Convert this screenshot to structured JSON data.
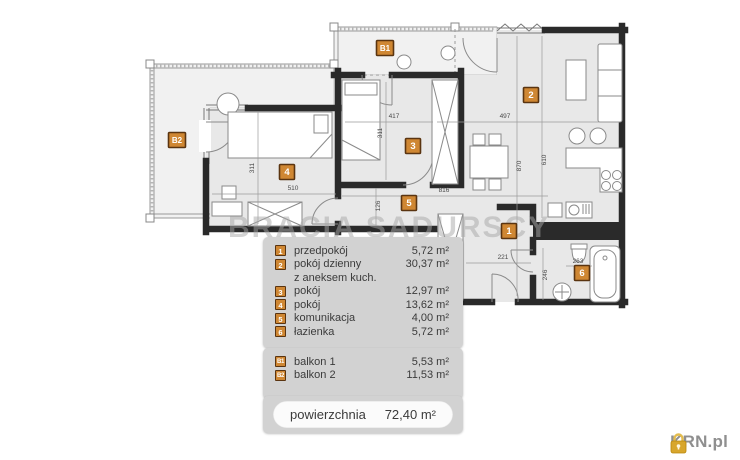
{
  "watermark": "BRACIA SADURSCY",
  "logo": {
    "icon": "padlock-icon",
    "text": "KRN.pl"
  },
  "legend": {
    "rooms": [
      {
        "id": "1",
        "label": "przedpokój",
        "area": "5,72 m²"
      },
      {
        "id": "2",
        "label": "pokój dzienny",
        "label2": "z aneksem kuch.",
        "area": "30,37 m²"
      },
      {
        "id": "3",
        "label": "pokój",
        "area": "12,97 m²"
      },
      {
        "id": "4",
        "label": "pokój",
        "area": "13,62 m²"
      },
      {
        "id": "5",
        "label": "komunikacja",
        "area": "4,00 m²"
      },
      {
        "id": "6",
        "label": "łazienka",
        "area": "5,72 m²"
      }
    ],
    "balconies": [
      {
        "id": "B1",
        "label": "balkon 1",
        "area": "5,53 m²"
      },
      {
        "id": "B2",
        "label": "balkon 2",
        "area": "11,53 m²"
      }
    ],
    "total": {
      "label": "powierzchnia",
      "area": "72,40 m²"
    }
  },
  "floorplan": {
    "badges": [
      {
        "id": "B2",
        "x": 177,
        "y": 140
      },
      {
        "id": "B1",
        "x": 385,
        "y": 48
      },
      {
        "id": "2",
        "x": 531,
        "y": 95
      },
      {
        "id": "3",
        "x": 413,
        "y": 146
      },
      {
        "id": "4",
        "x": 287,
        "y": 172
      },
      {
        "id": "5",
        "x": 409,
        "y": 203
      },
      {
        "id": "1",
        "x": 509,
        "y": 231
      },
      {
        "id": "6",
        "x": 582,
        "y": 273
      }
    ],
    "dimensions": [
      {
        "text": "417",
        "x": 394,
        "y": 118,
        "rot": 0
      },
      {
        "text": "497",
        "x": 505,
        "y": 118,
        "rot": 0
      },
      {
        "text": "311",
        "x": 382,
        "y": 133,
        "rot": 90
      },
      {
        "text": "311",
        "x": 254,
        "y": 168,
        "rot": 90
      },
      {
        "text": "510",
        "x": 293,
        "y": 190,
        "rot": 0
      },
      {
        "text": "816",
        "x": 444,
        "y": 192,
        "rot": 0
      },
      {
        "text": "126",
        "x": 380,
        "y": 206,
        "rot": 90
      },
      {
        "text": "870",
        "x": 521,
        "y": 166,
        "rot": 90
      },
      {
        "text": "610",
        "x": 546,
        "y": 160,
        "rot": 90
      },
      {
        "text": "221",
        "x": 503,
        "y": 259,
        "rot": 0
      },
      {
        "text": "246",
        "x": 547,
        "y": 275,
        "rot": 90
      },
      {
        "text": "263",
        "x": 578,
        "y": 263,
        "rot": 0
      }
    ],
    "colors": {
      "badge": "#cf8733",
      "badge_border": "#5a3410",
      "wall": "#2a2a2a",
      "floor": "#e8e8e8"
    }
  }
}
